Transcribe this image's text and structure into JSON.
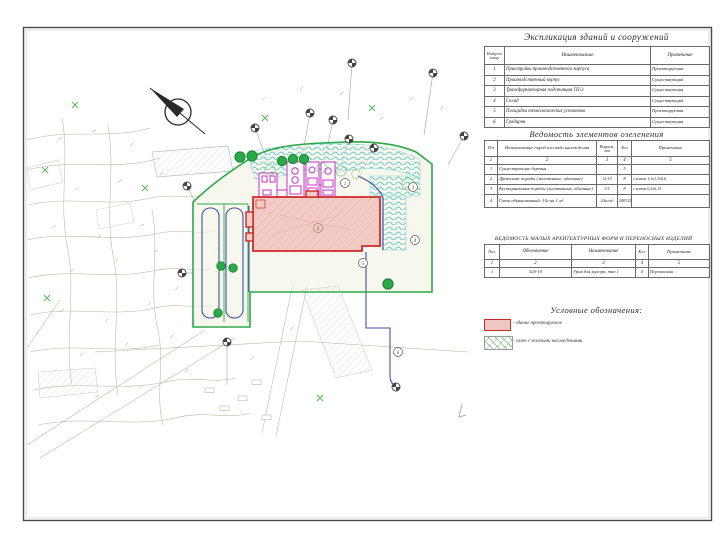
{
  "explication": {
    "title": "Экспликация зданий и сооружений",
    "headers": {
      "num": "Номер по плану",
      "name": "Наименование",
      "note": "Примечание"
    },
    "rows": [
      {
        "num": "1",
        "name": "Пристройка производственного корпуса",
        "note": "Проектируемая"
      },
      {
        "num": "2",
        "name": "Производственный корпус",
        "note": "Существующий"
      },
      {
        "num": "3",
        "name": "Трансформаторная подстанция ТП-3",
        "note": "Существующая"
      },
      {
        "num": "4",
        "name": "Склад",
        "note": "Существующий"
      },
      {
        "num": "5",
        "name": "Площадка технологических установок",
        "note": "Проектируемая"
      },
      {
        "num": "6",
        "name": "Градирня",
        "note": "Существующая"
      }
    ]
  },
  "greenery": {
    "title": "Ведомость элементов озеленения",
    "headers": {
      "pos": "Поз",
      "name": "Наименование пород или вида насаждения",
      "age": "Возраст, лет",
      "qty": "Кол",
      "note": "Примечание"
    },
    "col_numbers": [
      "1",
      "2",
      "3",
      "4",
      "5"
    ],
    "rows": [
      {
        "pos": "1",
        "name": "Существующие деревья",
        "age": "",
        "qty": "5",
        "note": ""
      },
      {
        "pos": "2",
        "name": "Древесные породы (лиственные, обычные)",
        "age": "12-15",
        "qty": "8",
        "note": "с комом 1,3х1,3х0,6"
      },
      {
        "pos": "3",
        "name": "Кустарниковые породы (лиственные, обычные)",
        "age": "3-5",
        "qty": "8",
        "note": "с комом 0,2х0,15"
      },
      {
        "pos": "4",
        "name": "Газон обыкновенный: 10г на 1 м²",
        "age": "0,4кг/м²",
        "qty": "2083/23",
        "note": ""
      }
    ]
  },
  "maf": {
    "title": "ВЕДОМОСТЬ МАЛЫХ АРХИТЕКТУРНЫХ ФОРМ И ПЕРЕНОСНЫХ ИЗДЕЛИЙ",
    "headers": {
      "pos": "Поз.",
      "code": "Обозначение",
      "name": "Наименование",
      "qty": "Кол.",
      "note": "Примечание"
    },
    "col_numbers": [
      "1",
      "2",
      "3",
      "4",
      "5"
    ],
    "rows": [
      {
        "pos": "1",
        "code": "320-10",
        "name": "Урна для мусора, тип 1",
        "qty": "5",
        "note": "Переносная"
      }
    ]
  },
  "legend": {
    "title": "Условные обозначения:",
    "items": [
      {
        "label": "- здание проектируемое"
      },
      {
        "label": "- газон с зелеными насаждениями"
      }
    ]
  },
  "plan": {
    "markers": [
      "1",
      "2",
      "3",
      "4",
      "5",
      "6"
    ],
    "colors": {
      "projected_building_stroke": "#cc2a2a",
      "projected_building_fill": "#f2cbc5",
      "site_boundary_green": "#2aa84a",
      "lawn_cyan": "#3fc0c0",
      "equipment_magenta": "#c433c4",
      "path_blue": "#3b52a2"
    }
  }
}
